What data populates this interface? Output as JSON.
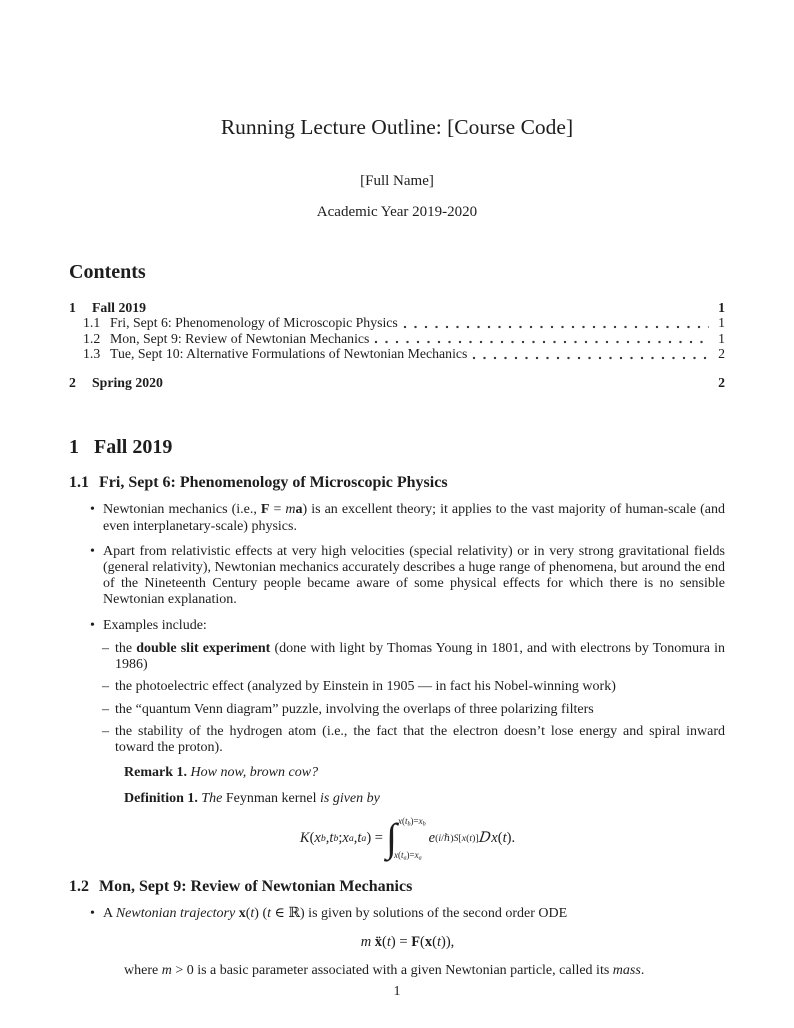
{
  "colors": {
    "text": "#1d1d1d",
    "background": "#ffffff"
  },
  "markers": {
    "bullet": "•",
    "dash": "–"
  },
  "header": {
    "title": "Running Lecture Outline: [Course Code]",
    "author": "[Full Name]",
    "date": "Academic Year 2019-2020"
  },
  "contents": {
    "heading": "Contents",
    "entries": [
      {
        "num": "1",
        "label": "Fall 2019",
        "page": "1",
        "level": 1
      },
      {
        "num": "1.1",
        "label": "Fri, Sept 6: Phenomenology of Microscopic Physics",
        "page": "1",
        "level": 2
      },
      {
        "num": "1.2",
        "label": "Mon, Sept 9: Review of Newtonian Mechanics",
        "page": "1",
        "level": 2
      },
      {
        "num": "1.3",
        "label": "Tue, Sept 10: Alternative Formulations of Newtonian Mechanics",
        "page": "2",
        "level": 2
      },
      {
        "num": "2",
        "label": "Spring 2020",
        "page": "2",
        "level": 1
      }
    ]
  },
  "sections": {
    "fall": {
      "num": "1",
      "title": "Fall 2019"
    },
    "phenomenology": {
      "num": "1.1",
      "title": "Fri, Sept 6: Phenomenology of Microscopic Physics",
      "b1": {
        "runs": [
          {
            "t": "Newtonian mechanics (i.e., "
          },
          {
            "t": "F",
            "s": "b"
          },
          {
            "t": " = "
          },
          {
            "t": "m",
            "s": "i"
          },
          {
            "t": "a",
            "s": "b"
          },
          {
            "t": ") is an excellent theory; it applies to the vast majority of human-scale (and even interplanetary-scale) physics."
          }
        ]
      },
      "b2": {
        "runs": [
          {
            "t": "Apart from relativistic effects at very high velocities (special relativity) or in very strong gravitational fields (general relativity), Newtonian mechanics accurately describes a huge range of phenomena, but around the end of the Nineteenth Century people became aware of some physical effects for which there is no sensible Newtonian explanation."
          }
        ]
      },
      "b3": {
        "runs": [
          {
            "t": "Examples include:"
          }
        ]
      },
      "e1": {
        "runs": [
          {
            "t": "the "
          },
          {
            "t": "double slit experiment",
            "s": "b"
          },
          {
            "t": " (done with light by Thomas Young in 1801, and with electrons by Tonomura in 1986)"
          }
        ]
      },
      "e2": {
        "runs": [
          {
            "t": "the photoelectric effect (analyzed by Einstein in 1905 — in fact his Nobel-winning work)"
          }
        ]
      },
      "e3": {
        "runs": [
          {
            "t": "the “quantum Venn diagram” puzzle, involving the overlaps of three polarizing filters"
          }
        ]
      },
      "e4": {
        "runs": [
          {
            "t": "the stability of the hydrogen atom (i.e., the fact that the electron doesn’t lose energy and spiral inward toward the proton)."
          }
        ]
      },
      "remark": {
        "runs": [
          {
            "t": "Remark 1.",
            "s": "b"
          },
          {
            "t": " How now, brown cow?",
            "s": "i"
          }
        ]
      },
      "definition": {
        "runs": [
          {
            "t": "Definition 1.",
            "s": "b"
          },
          {
            "t": " The ",
            "s": "i"
          },
          {
            "t": "Feynman kernel"
          },
          {
            "t": " is given by",
            "s": "i"
          }
        ]
      },
      "kernel_formula": {
        "runs": [
          {
            "t": "K",
            "s": "i"
          },
          {
            "t": "("
          },
          {
            "t": "x",
            "s": "i"
          },
          {
            "t": "b",
            "s": "i sub"
          },
          {
            "t": ", "
          },
          {
            "t": "t",
            "s": "i"
          },
          {
            "t": "b",
            "s": "i sub"
          },
          {
            "t": "; "
          },
          {
            "t": "x",
            "s": "i"
          },
          {
            "t": "a",
            "s": "i sub"
          },
          {
            "t": ", "
          },
          {
            "t": "t",
            "s": "i"
          },
          {
            "t": "a",
            "s": "i sub"
          },
          {
            "t": ") = "
          },
          {
            "s": "int",
            "sup": [
              {
                "t": "x",
                "s": "i"
              },
              {
                "t": "("
              },
              {
                "t": "t",
                "s": "i"
              },
              {
                "t": "b",
                "s": "i sub"
              },
              {
                "t": ")="
              },
              {
                "t": "x",
                "s": "i"
              },
              {
                "t": "b",
                "s": "i sub"
              }
            ],
            "sub": [
              {
                "t": "x",
                "s": "i"
              },
              {
                "t": "("
              },
              {
                "t": "t",
                "s": "i"
              },
              {
                "t": "a",
                "s": "i sub"
              },
              {
                "t": ")="
              },
              {
                "t": "x",
                "s": "i"
              },
              {
                "t": "a",
                "s": "i sub"
              }
            ]
          },
          {
            "t": "e",
            "s": "i"
          },
          {
            "s": "sup",
            "r": [
              {
                "t": "("
              },
              {
                "t": "i",
                "s": "i"
              },
              {
                "t": "/ℏ)"
              },
              {
                "t": "S",
                "s": "i"
              },
              {
                "t": "["
              },
              {
                "t": "x",
                "s": "i"
              },
              {
                "t": "("
              },
              {
                "t": "t",
                "s": "i"
              },
              {
                "t": ")]"
              }
            ]
          },
          {
            "t": " "
          },
          {
            "t": "D",
            "s": "scr"
          },
          {
            "t": "x",
            "s": "i"
          },
          {
            "t": "("
          },
          {
            "t": "t",
            "s": "i"
          },
          {
            "t": ")."
          }
        ]
      }
    },
    "newtonian": {
      "num": "1.2",
      "title": "Mon, Sept 9: Review of Newtonian Mechanics",
      "b1": {
        "runs": [
          {
            "t": "A "
          },
          {
            "t": "Newtonian trajectory",
            "s": "i"
          },
          {
            "t": " "
          },
          {
            "t": "x",
            "s": "b"
          },
          {
            "t": "("
          },
          {
            "t": "t",
            "s": "i"
          },
          {
            "t": ") ("
          },
          {
            "t": "t",
            "s": "i"
          },
          {
            "t": " ∈ ℝ) is given by solutions of the second order ODE"
          }
        ]
      },
      "ode_formula": {
        "runs": [
          {
            "t": "m",
            "s": "i"
          },
          {
            "t": " "
          },
          {
            "t": "ẍ",
            "s": "b"
          },
          {
            "t": "("
          },
          {
            "t": "t",
            "s": "i"
          },
          {
            "t": ") = "
          },
          {
            "t": "F",
            "s": "b"
          },
          {
            "t": "("
          },
          {
            "t": "x",
            "s": "b"
          },
          {
            "t": "("
          },
          {
            "t": "t",
            "s": "i"
          },
          {
            "t": ")),"
          }
        ]
      },
      "where_line": {
        "runs": [
          {
            "t": "where "
          },
          {
            "t": "m",
            "s": "i"
          },
          {
            "t": " > 0 is a basic parameter associated with a given Newtonian particle, called its "
          },
          {
            "t": "mass",
            "s": "i"
          },
          {
            "t": "."
          }
        ]
      }
    }
  },
  "footer": {
    "page_number": "1"
  }
}
